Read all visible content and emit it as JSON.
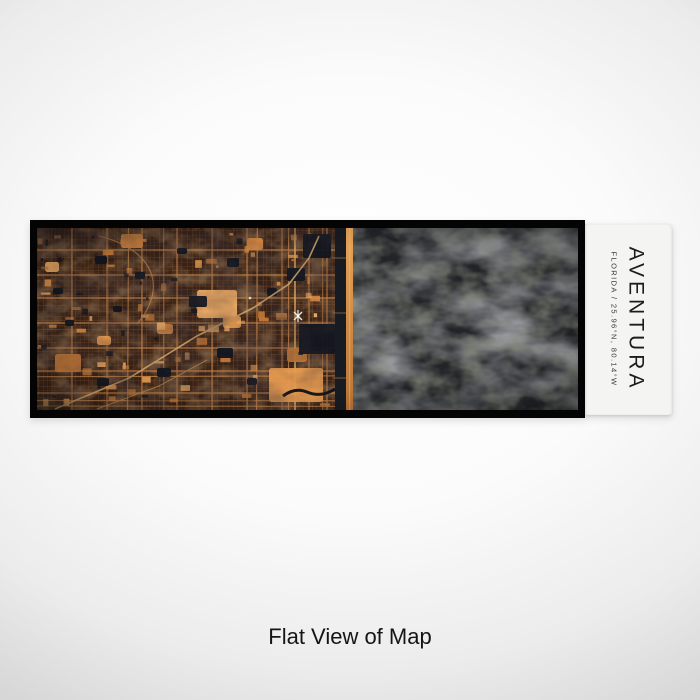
{
  "product": {
    "city": "AVENTURA",
    "region_line": "FLORIDA / 25.96°N, 80.14°W",
    "caption": "Flat View of Map"
  },
  "map": {
    "style": "ember-dark-streetmap",
    "colors": {
      "land_base": "#382216",
      "street": "#8a5a34",
      "street_major": "#c08048",
      "boulevard": "#d9a55e",
      "patch_orange": "#e59a50",
      "patch_orange_alt": "#c97c38",
      "lake": "#12161f",
      "waterway": "#181b21",
      "beach_top": "#e8a658",
      "beach_bottom": "#b97333",
      "ocean_base": "#222428",
      "ocean_swirl": "#4a4c49",
      "marker_white": "#f2e8d6"
    }
  },
  "label_panel": {
    "bg": "#f4f4f2",
    "text_color": "#1c1c1c"
  },
  "caption_color": "#151515"
}
